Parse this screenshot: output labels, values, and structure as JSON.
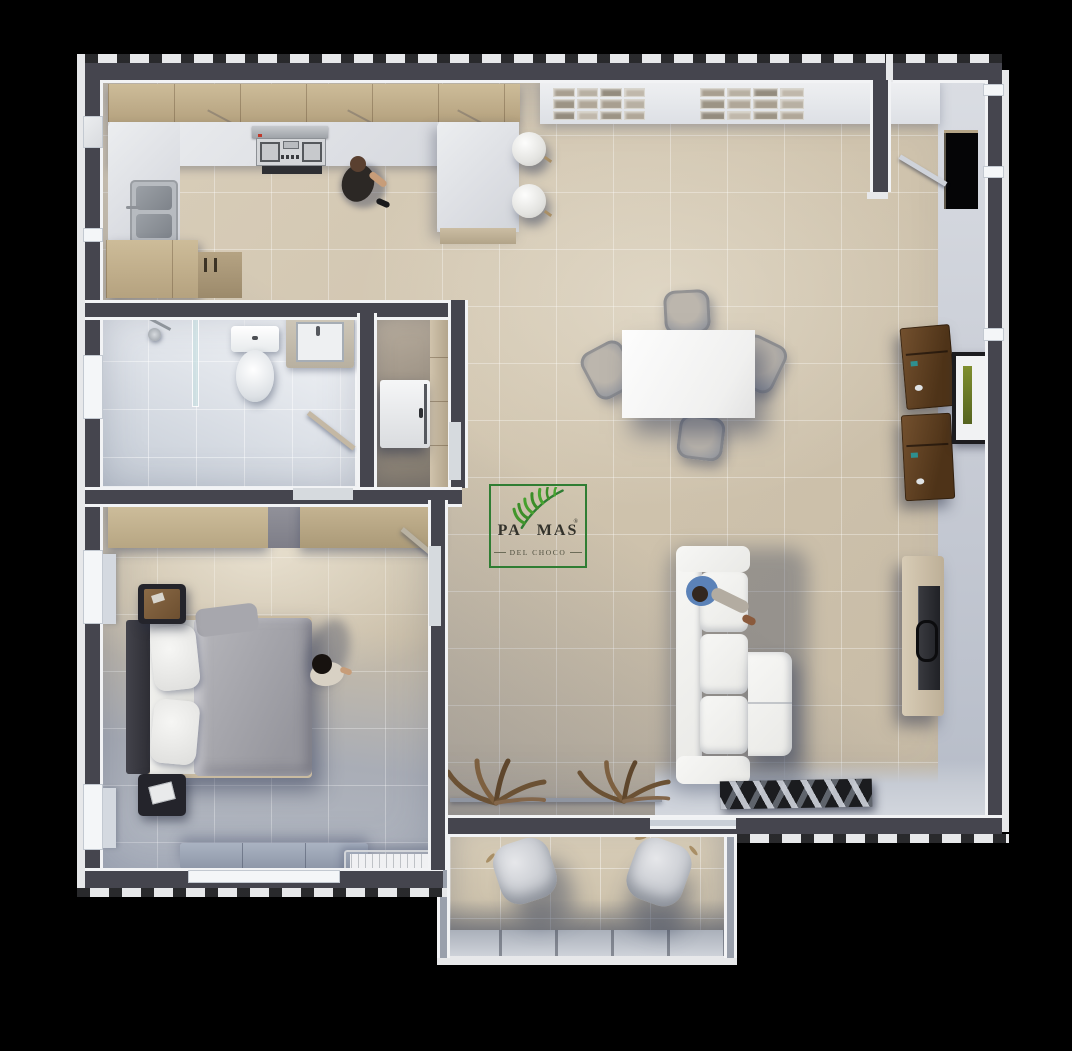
{
  "scene": {
    "type": "3d-apartment-floor-plan-render",
    "background_color": "#000000",
    "logo": {
      "brand_prefix": "PA",
      "brand_suffix": "MAS",
      "registered": "®",
      "tagline": "DEL CHOCO",
      "border_color": "#2f7d33",
      "leaf_color": "#3f8f2a",
      "text_color": "#33322b"
    },
    "palette": {
      "wall_dark": "#45454e",
      "wall_edge_white": "#f2f3f5",
      "floor_beige": "#cfc3ad",
      "bath_marble": "#e0e4ea",
      "bedroom_gray": "#a9adb6",
      "wood_cabinet": "#c1ae8b",
      "counter_marble": "#e0e2e6",
      "desk_wood": "#5f4126",
      "sofa_white": "#f3f3f0",
      "rug_dark": "#1b1c1f",
      "shadow_blue": "#3a445e"
    },
    "rooms": [
      {
        "name": "kitchen",
        "furniture": [
          "upper-cabinets",
          "range-hood",
          "stove-cooktop",
          "marble-counter",
          "double-sink",
          "base-cabinet",
          "bar-peninsula",
          "bar-stool",
          "bar-stool",
          "person-cooking"
        ]
      },
      {
        "name": "living-dining",
        "furniture": [
          "wall-art-tiles",
          "dining-table",
          "dining-chair",
          "dining-chair",
          "dining-chair",
          "dining-chair",
          "desk",
          "desk",
          "picture-frame",
          "sectional-sofa",
          "person-seated",
          "tv-console",
          "tv",
          "dry-plant",
          "dry-plant",
          "plant-ledge",
          "geometric-rug",
          "entry-door"
        ]
      },
      {
        "name": "bathroom",
        "furniture": [
          "shower-head",
          "glass-screen",
          "toilet",
          "vanity-sink",
          "swing-door"
        ]
      },
      {
        "name": "laundry",
        "furniture": [
          "washing-machine",
          "tall-cabinet"
        ]
      },
      {
        "name": "bedroom",
        "furniture": [
          "wardrobe-closet",
          "double-bed",
          "headboard",
          "pillow",
          "pillow",
          "nightstand",
          "nightstand",
          "person-standing",
          "bench",
          "ac-console",
          "swing-door"
        ]
      },
      {
        "name": "balcony",
        "furniture": [
          "lounge-chair",
          "lounge-chair",
          "railing-wall"
        ]
      }
    ],
    "decor": {
      "wall_art": {
        "groups": 2,
        "rows": 3,
        "cols": 4
      },
      "tile_colors": [
        "#a89f90",
        "#b8b0a3",
        "#948c7e",
        "#c0b8ab",
        "#9c9485",
        "#b0a798"
      ]
    }
  }
}
